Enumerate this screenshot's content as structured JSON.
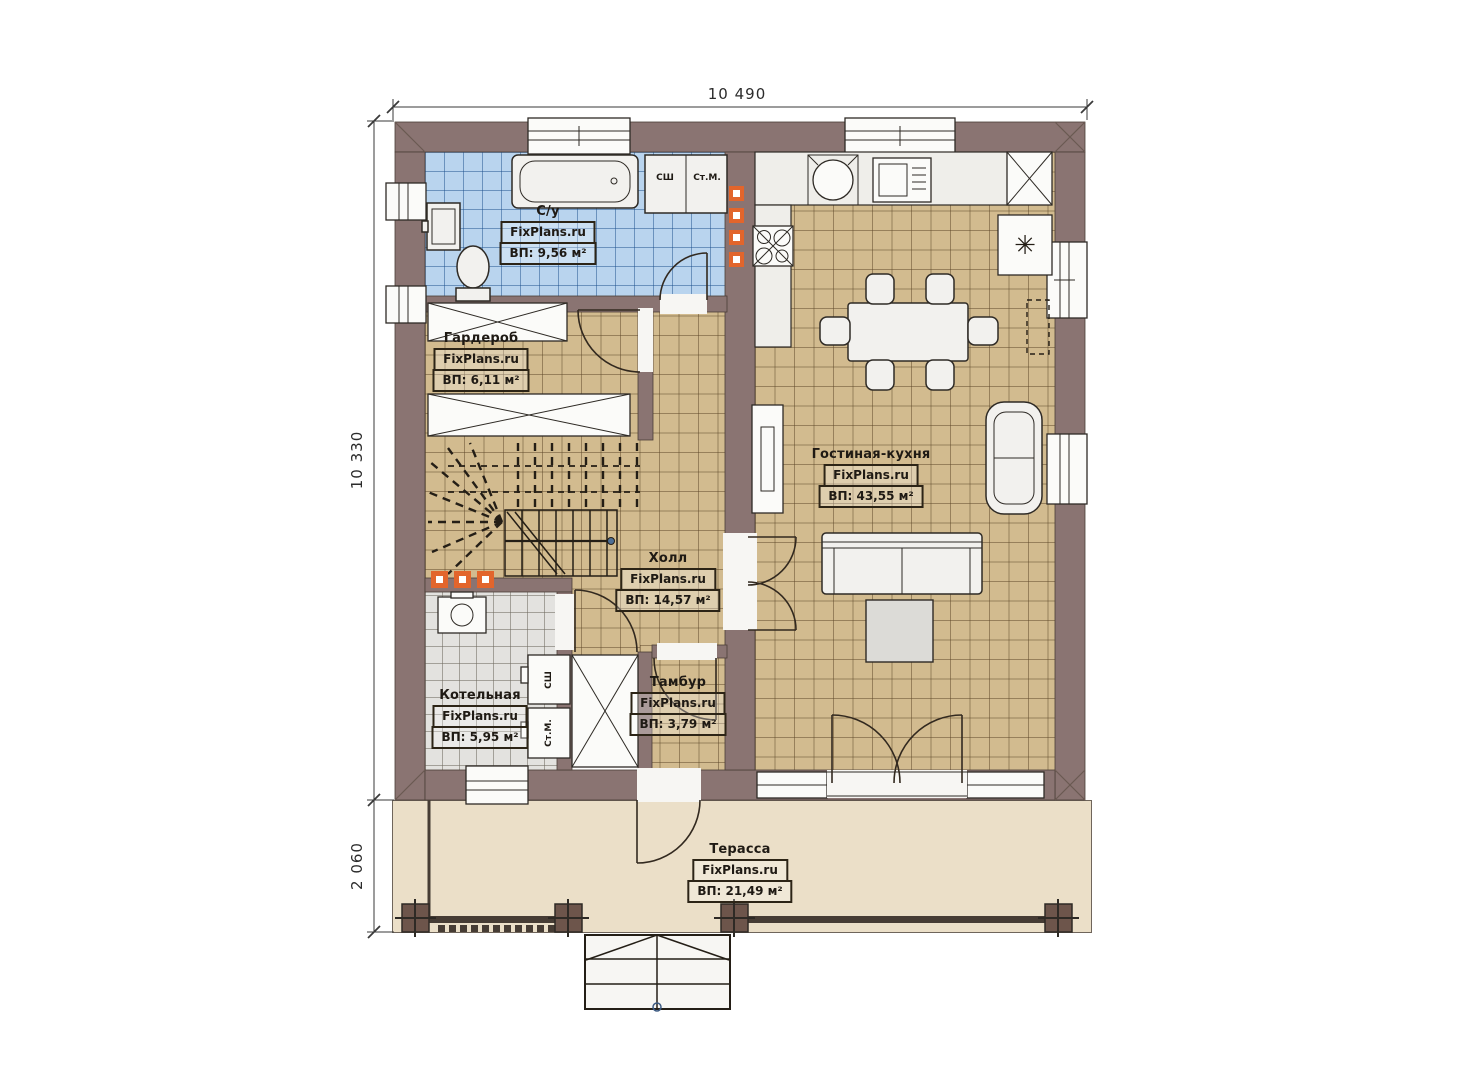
{
  "brand": {
    "watermark": "FixPlans.ru"
  },
  "dimensions": {
    "width_top": "10 490",
    "depth_house": "10 330",
    "depth_terrace": "2 060"
  },
  "rooms": {
    "bathroom": {
      "name": "С/у",
      "area": "ВП: 9,56 м²"
    },
    "wardrobe": {
      "name": "Гардероб",
      "area": "ВП: 6,11 м²"
    },
    "living_kitchen": {
      "name": "Гостиная-кухня",
      "area": "ВП: 43,55 м²"
    },
    "hall": {
      "name": "Холл",
      "area": "ВП: 14,57 м²"
    },
    "boiler": {
      "name": "Котельная",
      "area": "ВП: 5,95 м²"
    },
    "vestibule": {
      "name": "Тамбур",
      "area": "ВП: 3,79 м²"
    },
    "terrace": {
      "name": "Терасса",
      "area": "ВП: 21,49 м²"
    }
  },
  "appliances": {
    "drying_cabinet": "СШ",
    "washing_machine": "Ст.М."
  },
  "icons": {
    "fridge_snowflake": "✳"
  },
  "colors": {
    "wall": "#8a7472",
    "floor": "#d2bb8f",
    "bath-floor": "#b9d4ee",
    "boiler-floor": "#e3e2df",
    "terrace-floor": "#ebdfc8",
    "accent": "#e2652c",
    "line": "#2e2a25"
  }
}
